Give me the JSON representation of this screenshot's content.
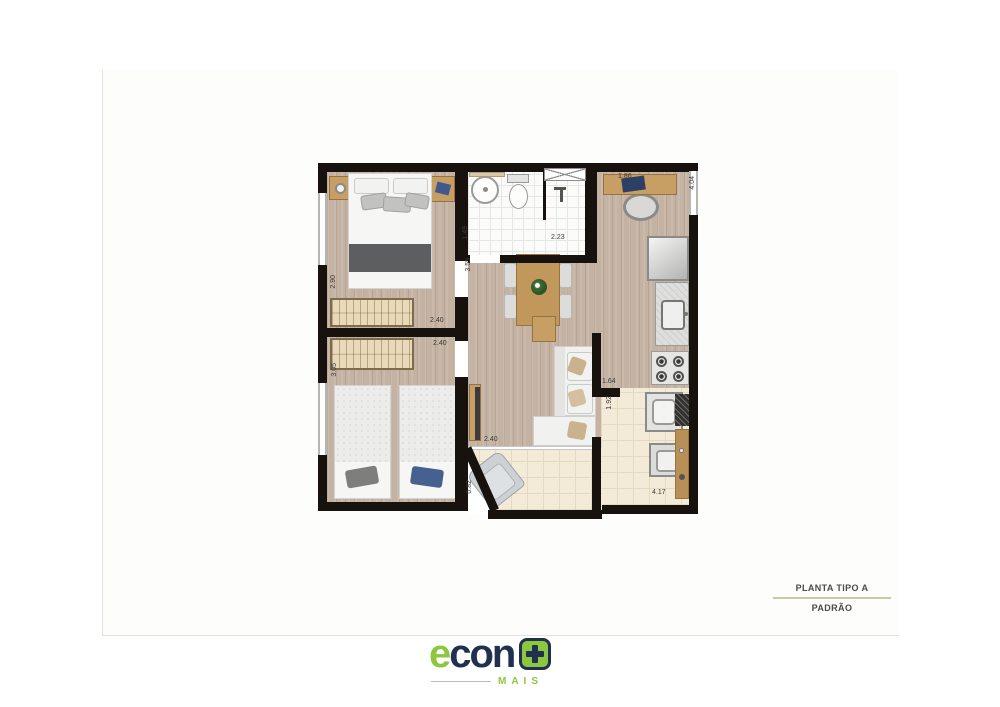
{
  "plan": {
    "labels": {
      "office_width": "1.86",
      "office_depth": "4.04",
      "bath_depth": "1.49",
      "bath_width": "2.23",
      "hall_depth": "3.55",
      "master_width": "2.40",
      "master_depth": "2.90",
      "bedroom2_width": "2.40",
      "bedroom2_depth": "3.05",
      "kitchen_pass_width": "1.64",
      "service_pass_depth": "1.92",
      "balcony_width": "2.40",
      "balcony_depth": "0.82",
      "service_width": "4.17"
    }
  },
  "titleblock": {
    "title": "PLANTA TIPO A",
    "subtitle": "PADRÃO"
  },
  "logo": {
    "brand_e": "e",
    "brand_rest": "con",
    "tagline": "MAIS"
  },
  "colors": {
    "brand_green": "#8dc63f",
    "brand_navy": "#22304f",
    "wall": "#17120e",
    "wood_floor": "#c4b2a3",
    "tile_floor": "#f3ebd8",
    "title_rule": "#cbc8a6"
  }
}
